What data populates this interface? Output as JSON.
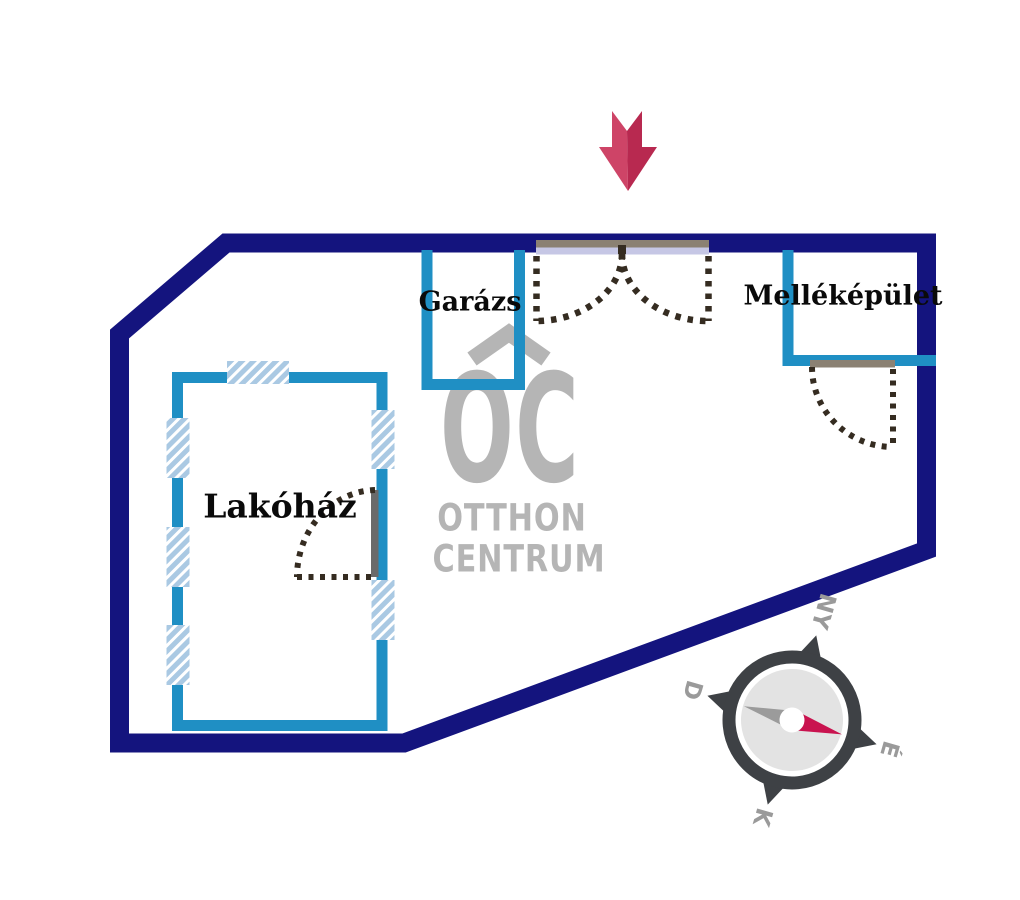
{
  "plan": {
    "type": "site-plan",
    "buildings": {
      "house": "Lakóház",
      "garage": "Garázs",
      "outbuilding": "Melléképület"
    }
  },
  "watermark": {
    "monogram": "OC",
    "line1": "OTTHON",
    "line2": "CENTRUM"
  },
  "compass": {
    "north": "É",
    "south": "D",
    "east": "K",
    "west": "NY"
  },
  "colors": {
    "boundary": "#14147e",
    "building": "#1f8fc4",
    "window_fill": "#aac9e3",
    "window_stripe": "#ffffff",
    "gate_bar": "#8b8173",
    "gate_fill": "#c6c7e5",
    "door_leaf": "#6a6a6a",
    "dotted": "#352c21",
    "logo": "#b5b5b5",
    "compass_ring": "#3e4145",
    "compass_face": "#e3e3e3",
    "compass_label": "#9a9a9a",
    "needle_gray": "#9b9b9b",
    "needle_red": "#c9134f",
    "arrow_light": "#ce4467",
    "arrow_dark": "#b82950"
  }
}
